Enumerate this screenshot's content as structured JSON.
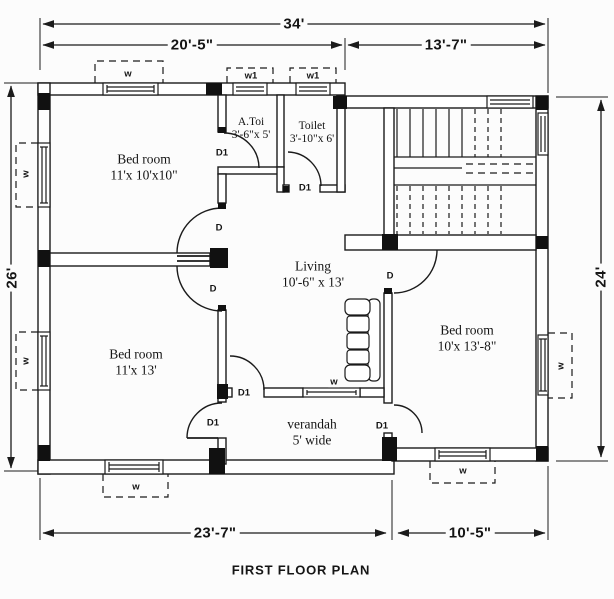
{
  "title": "FIRST FLOOR PLAN",
  "dims": {
    "total_width": "34'",
    "top_left": "20'-5\"",
    "top_right": "13'-7\"",
    "left_height": "26'",
    "right_height": "24'",
    "bottom_left": "23'-7\"",
    "bottom_right": "10'-5\""
  },
  "rooms": {
    "bedroom_top_left": {
      "name": "Bed room",
      "size": "11'x 10'x10\""
    },
    "attached_toilet": {
      "name": "A.Toi",
      "size": "3'-6\"x 5'"
    },
    "toilet": {
      "name": "Toilet",
      "size": "3'-10\"x 6'"
    },
    "living": {
      "name": "Living",
      "size": "10'-6\" x 13'"
    },
    "bedroom_bottom_left": {
      "name": "Bed room",
      "size": "11'x 13'"
    },
    "bedroom_bottom_right": {
      "name": "Bed room",
      "size": "10'x 13'-8\""
    },
    "verandah": {
      "name": "verandah",
      "size": "5' wide"
    }
  },
  "labels": {
    "door": "D",
    "door_1": "D1",
    "window": "w",
    "window_1": "w1"
  },
  "colors": {
    "line": "#1b1b1b",
    "background": "#fcfcfc"
  }
}
